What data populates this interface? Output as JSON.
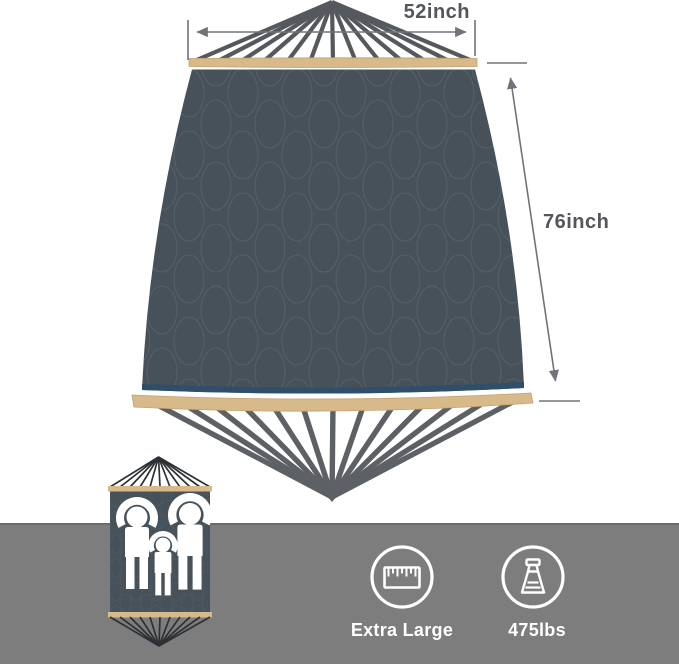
{
  "diagram": {
    "width_label": "52inch",
    "length_label": "76inch"
  },
  "features": {
    "size": {
      "icon": "ruler-icon",
      "label": "Extra Large"
    },
    "weight_capacity": {
      "icon": "weight-icon",
      "label": "475lbs"
    }
  },
  "thumbnail": {
    "icon": "family-capacity-icon"
  },
  "colors": {
    "fabric": "#46515A",
    "quilt_stitch": "#5E6970",
    "spreader_bar": "#D8B98A",
    "rope": "#55595D",
    "trim_strip": "#2F4E6B",
    "dimension_line": "#70747A",
    "dimension_text": "#53565A",
    "footer_band": "#7D7D7D",
    "icon": "#FFFFFF"
  }
}
